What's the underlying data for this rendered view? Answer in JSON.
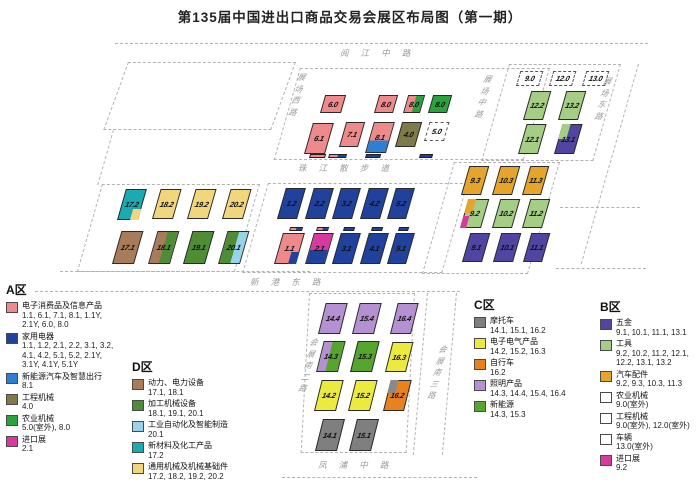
{
  "title": "第135届中国进出口商品交易会展区布局图（第一期）",
  "map": {
    "road_labels": [
      {
        "text": "阅江中路",
        "x": 340,
        "y": 47,
        "orient": "h"
      },
      {
        "text": "展场西路",
        "x": 293,
        "y": 72,
        "orient": "v"
      },
      {
        "text": "展场中路",
        "x": 479,
        "y": 74,
        "orient": "v"
      },
      {
        "text": "展场东路",
        "x": 599,
        "y": 76,
        "orient": "v"
      },
      {
        "text": "珠江散步道",
        "x": 298,
        "y": 162,
        "orient": "h"
      },
      {
        "text": "新港东路",
        "x": 250,
        "y": 276,
        "orient": "h"
      },
      {
        "text": "会展南二路",
        "x": 304,
        "y": 337,
        "orient": "v"
      },
      {
        "text": "会展南三路",
        "x": 433,
        "y": 344,
        "orient": "v"
      },
      {
        "text": "凤浦中路",
        "x": 318,
        "y": 459,
        "orient": "h"
      }
    ],
    "halls": [
      {
        "label": "6.0",
        "x": 320,
        "y": 95,
        "w": 21,
        "h": 18,
        "fill": "#ee8a8c"
      },
      {
        "label": "8.0",
        "x": 374,
        "y": 95,
        "w": 19,
        "h": 18,
        "fill": "#ee8a8c"
      },
      {
        "label": "8.0",
        "x": 403,
        "y": 95,
        "w": 17,
        "h": 18,
        "split": {
          "dir": "v",
          "at": 50,
          "colors": [
            "#ee8a8c",
            "#2aa33c"
          ]
        }
      },
      {
        "label": "8.0",
        "x": 428,
        "y": 95,
        "w": 19,
        "h": 18,
        "fill": "#2aa33c"
      },
      {
        "label": "6.1",
        "x": 304,
        "y": 123,
        "w": 21,
        "h": 31,
        "fill": "#ee8a8c"
      },
      {
        "label": "7.1",
        "x": 339,
        "y": 122,
        "w": 19,
        "h": 25,
        "fill": "#ee8a8c"
      },
      {
        "label": "8.1",
        "x": 365,
        "y": 122,
        "w": 21,
        "h": 31,
        "split": {
          "dir": "h",
          "at": 60,
          "colors": [
            "#ee8a8c",
            "#2d7fd2"
          ]
        }
      },
      {
        "label": "4.0",
        "x": 395,
        "y": 122,
        "w": 20,
        "h": 25,
        "fill": "#7e7b49"
      },
      {
        "label": "5.0",
        "x": 424,
        "y": 122,
        "w": 20,
        "h": 19,
        "outdoor": true
      },
      {
        "label": "9.0",
        "x": 516,
        "y": 71,
        "w": 23,
        "h": 15,
        "outdoor": true
      },
      {
        "label": "12.0",
        "x": 549,
        "y": 71,
        "w": 23,
        "h": 15,
        "outdoor": true
      },
      {
        "label": "13.0",
        "x": 582,
        "y": 71,
        "w": 23,
        "h": 15,
        "outdoor": true
      },
      {
        "label": "12.2",
        "x": 523,
        "y": 91,
        "w": 20,
        "h": 29,
        "fill": "#a5cd86"
      },
      {
        "label": "13.2",
        "x": 558,
        "y": 91,
        "w": 20,
        "h": 29,
        "fill": "#a5cd86"
      },
      {
        "label": "12.1",
        "x": 518,
        "y": 124,
        "w": 20,
        "h": 30,
        "fill": "#a5cd86"
      },
      {
        "label": "13.1",
        "x": 554,
        "y": 124,
        "w": 20,
        "h": 30,
        "fill": "#5046a2",
        "corners": [
          {
            "pos": "tl",
            "w": 0.45,
            "h": 0.55,
            "color": "#a5cd86"
          }
        ]
      },
      {
        "label": "17.2",
        "x": 117,
        "y": 189,
        "w": 21,
        "h": 31,
        "fill": "#1caab2",
        "corners": [
          {
            "pos": "br",
            "w": 0.42,
            "h": 0.38,
            "color": "#f2d67c"
          }
        ]
      },
      {
        "label": "18.2",
        "x": 152,
        "y": 189,
        "w": 21,
        "h": 30,
        "fill": "#f2d67c"
      },
      {
        "label": "19.2",
        "x": 187,
        "y": 189,
        "w": 21,
        "h": 30,
        "fill": "#f2d67c"
      },
      {
        "label": "20.2",
        "x": 222,
        "y": 189,
        "w": 21,
        "h": 30,
        "fill": "#f2d67c"
      },
      {
        "label": "17.1",
        "x": 112,
        "y": 231,
        "w": 22,
        "h": 33,
        "fill": "#a87c5b"
      },
      {
        "label": "18.1",
        "x": 148,
        "y": 231,
        "w": 22,
        "h": 33,
        "split": {
          "dir": "v",
          "at": 48,
          "colors": [
            "#a87c5b",
            "#4e8c35"
          ]
        }
      },
      {
        "label": "19.1",
        "x": 183,
        "y": 231,
        "w": 22,
        "h": 33,
        "fill": "#4e8c35"
      },
      {
        "label": "20.1",
        "x": 218,
        "y": 231,
        "w": 22,
        "h": 33,
        "split": {
          "dir": "v",
          "at": 55,
          "colors": [
            "#4e8c35",
            "#97d4ea"
          ]
        }
      },
      {
        "label": "1.2",
        "x": 277,
        "y": 188,
        "w": 20,
        "h": 31,
        "fill": "#20429d"
      },
      {
        "label": "2.2",
        "x": 305,
        "y": 188,
        "w": 20,
        "h": 31,
        "fill": "#20429d"
      },
      {
        "label": "3.2",
        "x": 332,
        "y": 188,
        "w": 20,
        "h": 31,
        "fill": "#20429d"
      },
      {
        "label": "4.2",
        "x": 360,
        "y": 188,
        "w": 20,
        "h": 31,
        "fill": "#20429d"
      },
      {
        "label": "5.2",
        "x": 387,
        "y": 188,
        "w": 19,
        "h": 31,
        "fill": "#20429d"
      },
      {
        "label": "1.1",
        "x": 274,
        "y": 233,
        "w": 22,
        "h": 31,
        "fill": "#ee8a8c",
        "corners": [
          {
            "pos": "br",
            "w": 0.38,
            "h": 0.42,
            "color": "#20429d"
          }
        ]
      },
      {
        "label": "2.1",
        "x": 305,
        "y": 233,
        "w": 20,
        "h": 31,
        "split": {
          "dir": "h",
          "at": 55,
          "colors": [
            "#d63a9e",
            "#20429d"
          ]
        }
      },
      {
        "label": "3.1",
        "x": 332,
        "y": 233,
        "w": 20,
        "h": 31,
        "fill": "#20429d"
      },
      {
        "label": "4.1",
        "x": 360,
        "y": 233,
        "w": 20,
        "h": 31,
        "fill": "#20429d"
      },
      {
        "label": "5.1",
        "x": 387,
        "y": 233,
        "w": 19,
        "h": 31,
        "fill": "#20429d"
      },
      {
        "label": "9.3",
        "x": 461,
        "y": 166,
        "w": 20,
        "h": 29,
        "fill": "#e5a42c"
      },
      {
        "label": "10.3",
        "x": 492,
        "y": 166,
        "w": 20,
        "h": 29,
        "fill": "#e5a42c"
      },
      {
        "label": "11.3",
        "x": 522,
        "y": 166,
        "w": 19,
        "h": 29,
        "fill": "#e5a42c"
      },
      {
        "label": "9.2",
        "x": 460,
        "y": 199,
        "w": 21,
        "h": 29,
        "fill": "#a5cd86",
        "corners": [
          {
            "pos": "tl",
            "w": 0.4,
            "h": 0.5,
            "color": "#e5a42c"
          },
          {
            "pos": "bl",
            "w": 0.32,
            "h": 0.45,
            "color": "#d63a9e"
          }
        ]
      },
      {
        "label": "10.2",
        "x": 492,
        "y": 199,
        "w": 20,
        "h": 29,
        "fill": "#a5cd86"
      },
      {
        "label": "11.2",
        "x": 522,
        "y": 199,
        "w": 20,
        "h": 29,
        "fill": "#a5cd86"
      },
      {
        "label": "9.1",
        "x": 462,
        "y": 233,
        "w": 20,
        "h": 29,
        "fill": "#5046a2"
      },
      {
        "label": "10.1",
        "x": 493,
        "y": 233,
        "w": 20,
        "h": 29,
        "fill": "#5046a2"
      },
      {
        "label": "11.1",
        "x": 523,
        "y": 233,
        "w": 19,
        "h": 29,
        "fill": "#5046a2"
      },
      {
        "label": "14.4",
        "x": 318,
        "y": 303,
        "w": 22,
        "h": 31,
        "skew": -14,
        "fill": "#b691d2"
      },
      {
        "label": "15.4",
        "x": 352,
        "y": 303,
        "w": 22,
        "h": 31,
        "skew": -14,
        "fill": "#b691d2"
      },
      {
        "label": "16.4",
        "x": 390,
        "y": 303,
        "w": 21,
        "h": 31,
        "skew": -14,
        "fill": "#b691d2"
      },
      {
        "label": "14.3",
        "x": 316,
        "y": 341,
        "w": 22,
        "h": 31,
        "skew": -14,
        "split": {
          "dir": "v",
          "at": 40,
          "colors": [
            "#b691d2",
            "#55a52f"
          ]
        }
      },
      {
        "label": "15.3",
        "x": 350,
        "y": 341,
        "w": 22,
        "h": 31,
        "skew": -14,
        "fill": "#55a52f"
      },
      {
        "label": "16.3",
        "x": 385,
        "y": 342,
        "w": 21,
        "h": 30,
        "skew": -14,
        "fill": "#ece93f"
      },
      {
        "label": "14.2",
        "x": 314,
        "y": 380,
        "w": 22,
        "h": 31,
        "skew": -14,
        "fill": "#ece93f"
      },
      {
        "label": "15.2",
        "x": 348,
        "y": 380,
        "w": 22,
        "h": 31,
        "skew": -14,
        "fill": "#ece93f"
      },
      {
        "label": "16.2",
        "x": 383,
        "y": 380,
        "w": 21,
        "h": 31,
        "skew": -14,
        "fill": "#e8821f",
        "corners": [
          {
            "pos": "tl",
            "w": 0.42,
            "h": 0.45,
            "color": "#8a8a8a"
          }
        ]
      },
      {
        "label": "14.1",
        "x": 315,
        "y": 419,
        "w": 22,
        "h": 32,
        "skew": -14,
        "fill": "#7f7f7f"
      },
      {
        "label": "15.1",
        "x": 349,
        "y": 419,
        "w": 22,
        "h": 32,
        "skew": -14,
        "fill": "#7f7f7f"
      }
    ],
    "bars": [
      {
        "x": 309,
        "y": 154,
        "w": 16,
        "colors": [
          "#ee8a8c"
        ]
      },
      {
        "x": 328,
        "y": 154,
        "w": 18,
        "colors": [
          "#ee8a8c",
          "#20429d"
        ]
      },
      {
        "x": 365,
        "y": 154,
        "w": 15,
        "colors": [
          "#20429d"
        ]
      },
      {
        "x": 419,
        "y": 154,
        "w": 13,
        "colors": [
          "#20429d"
        ]
      },
      {
        "x": 289,
        "y": 227,
        "w": 13,
        "colors": [
          "#ee8a8c",
          "#20429d"
        ]
      },
      {
        "x": 316,
        "y": 227,
        "w": 12,
        "colors": [
          "#ee8a8c",
          "#20429d"
        ]
      },
      {
        "x": 343,
        "y": 227,
        "w": 11,
        "colors": [
          "#20429d"
        ]
      },
      {
        "x": 371,
        "y": 227,
        "w": 11,
        "colors": [
          "#20429d"
        ]
      },
      {
        "x": 398,
        "y": 227,
        "w": 10,
        "colors": [
          "#20429d"
        ]
      }
    ]
  },
  "legends": [
    {
      "id": "A",
      "title": "A区",
      "x": 6,
      "y": 281,
      "w": 125,
      "items": [
        {
          "color": "#ee8a8c",
          "name": "电子消费品及信息产品",
          "nums": "1.1, 6.1, 7.1, 8.1, 1.1Y,\n2.1Y, 6.0, 8.0"
        },
        {
          "color": "#20429d",
          "name": "家用电器",
          "nums": "1.1, 1.2, 2.1, 2.2, 3.1, 3.2,\n4.1, 4.2, 5.1, 5.2, 2.1Y,\n3.1Y, 4.1Y, 5.1Y"
        },
        {
          "color": "#2d7fd2",
          "name": "新能源汽车及智慧出行",
          "nums": "8.1"
        },
        {
          "color": "#7e7b49",
          "name": "工程机械",
          "nums": "4.0"
        },
        {
          "color": "#2aa33c",
          "name": "农业机械",
          "nums": "5.0(室外), 8.0"
        },
        {
          "color": "#d63a9e",
          "name": "进口展",
          "nums": "2.1"
        }
      ]
    },
    {
      "id": "D",
      "title": "D区",
      "x": 132,
      "y": 358,
      "w": 160,
      "items": [
        {
          "color": "#a87c5b",
          "name": "动力、电力设备",
          "nums": "17.1, 18.1"
        },
        {
          "color": "#4e8c35",
          "name": "加工机械设备",
          "nums": "18.1, 19.1, 20.1"
        },
        {
          "color": "#97d4ea",
          "name": "工业自动化及智能制造",
          "nums": "20.1"
        },
        {
          "color": "#1caab2",
          "name": "新材料及化工产品",
          "nums": "17.2"
        },
        {
          "color": "#f2d67c",
          "name": "通用机械及机械基础件",
          "nums": "17.2, 18.2, 19.2, 20.2"
        }
      ]
    },
    {
      "id": "C",
      "title": "C区",
      "x": 474,
      "y": 296,
      "w": 125,
      "items": [
        {
          "color": "#7f7f7f",
          "name": "摩托车",
          "nums": "14.1, 15.1, 16.2"
        },
        {
          "color": "#ece93f",
          "name": "电子电气产品",
          "nums": "14.2, 15.2, 16.3"
        },
        {
          "color": "#e8821f",
          "name": "自行车",
          "nums": "16.2"
        },
        {
          "color": "#b691d2",
          "name": "照明产品",
          "nums": "14.3, 14.4, 15.4, 16.4"
        },
        {
          "color": "#55a52f",
          "name": "新能源",
          "nums": "14.3, 15.3"
        }
      ]
    },
    {
      "id": "B",
      "title": "B区",
      "x": 600,
      "y": 298,
      "w": 100,
      "items": [
        {
          "color": "#5046a2",
          "name": "五金",
          "nums": "9.1, 10.1, 11.1, 13.1"
        },
        {
          "color": "#a5cd86",
          "name": "工具",
          "nums": "9.2, 10.2, 11.2, 12.1,\n12.2, 13.1, 13.2"
        },
        {
          "color": "#e5a42c",
          "name": "汽车配件",
          "nums": "9.2, 9.3, 10.3, 11.3"
        },
        {
          "color": "#ffffff",
          "name": "农业机械",
          "nums": "9.0(室外)"
        },
        {
          "color": "#ffffff",
          "name": "工程机械",
          "nums": "9.0(室外), 12.0(室外)"
        },
        {
          "color": "#ffffff",
          "name": "车辆",
          "nums": "13.0(室外)"
        },
        {
          "color": "#d63a9e",
          "name": "进口展",
          "nums": "9.2"
        }
      ]
    }
  ]
}
